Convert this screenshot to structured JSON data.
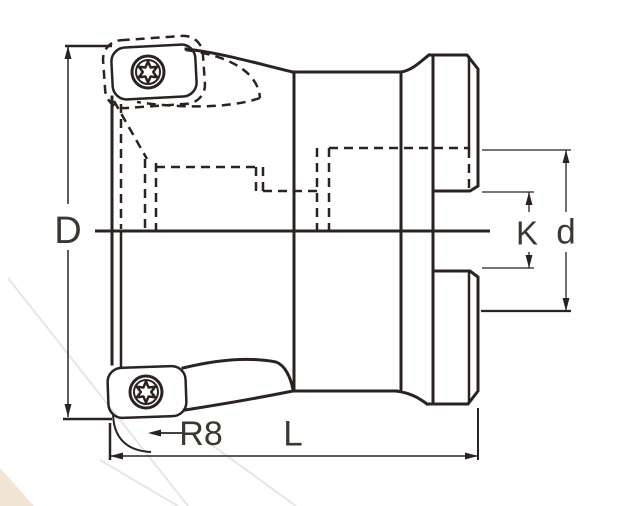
{
  "drawing": {
    "type": "technical-dimension-drawing",
    "subject": "indexable face milling cutter, side view with hidden bore lines",
    "labels": {
      "cutting_diameter": "D",
      "drive_slot_width": "K",
      "boss_diameter": "d",
      "overall_length": "L",
      "corner_radius": "R8"
    },
    "features": {
      "inserts": "round-cornered indexable inserts with torx screws (top and bottom)",
      "hidden_lines": "stepped arbor bore shown dashed in upper half",
      "rear": "chamfered rear boss with central drive slot"
    }
  },
  "colors": {
    "ink": "#2b2320",
    "label": "#3d3732",
    "background": "#ffffff",
    "watermark": "rgba(60,50,40,0.12)"
  },
  "icons": {
    "screw": "torx-screw-icon"
  }
}
